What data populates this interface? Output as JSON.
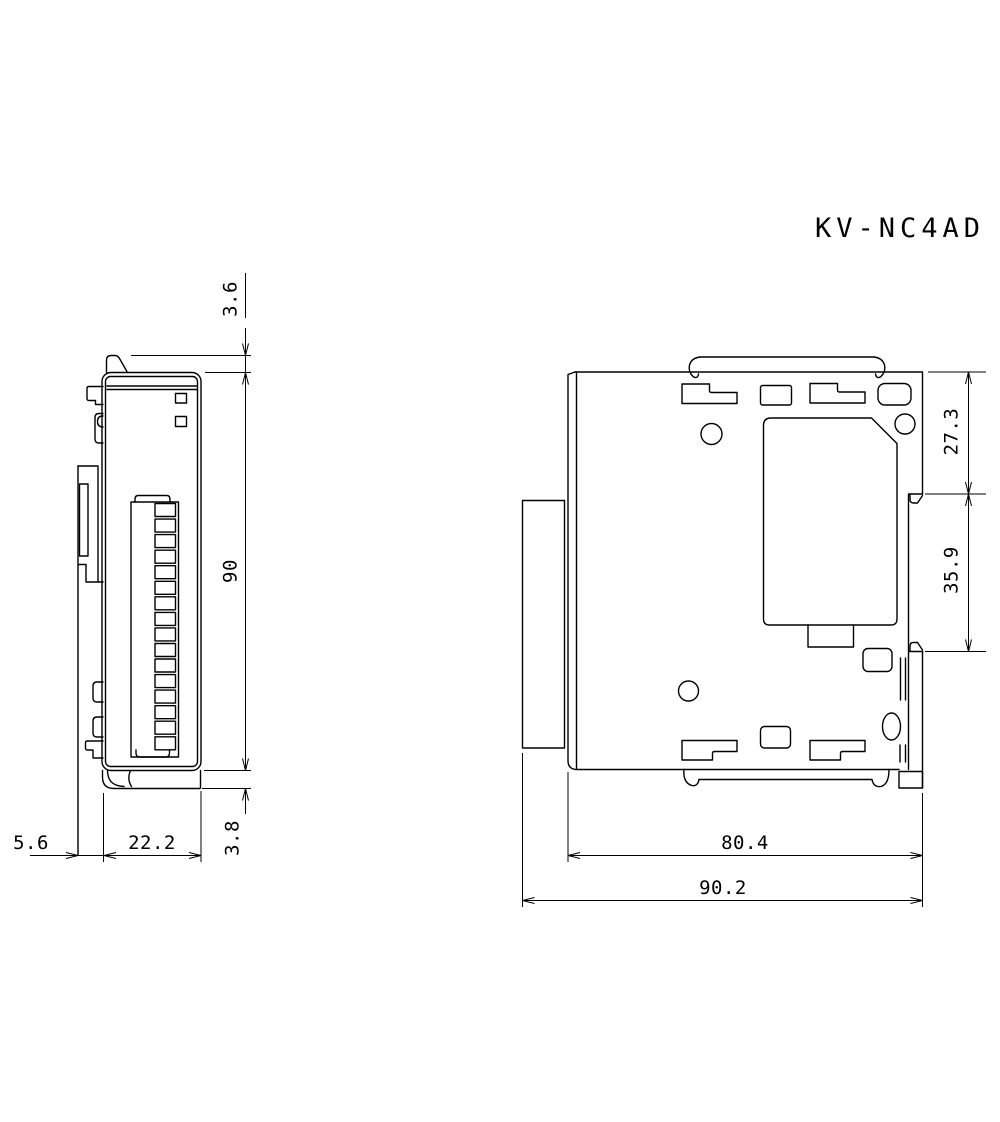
{
  "title": "KV-NC4AD",
  "colors": {
    "line": "#000000",
    "background": "#ffffff"
  },
  "front_view": {
    "dimensions": {
      "top_tab": "3.6",
      "body_height": "90",
      "bottom_tab": "3.8",
      "rail_offset": "5.6",
      "body_width": "22.2"
    }
  },
  "side_view": {
    "dimensions": {
      "upper_section": "27.3",
      "rail_section": "35.9",
      "inner_depth": "80.4",
      "overall_depth": "90.2"
    }
  }
}
